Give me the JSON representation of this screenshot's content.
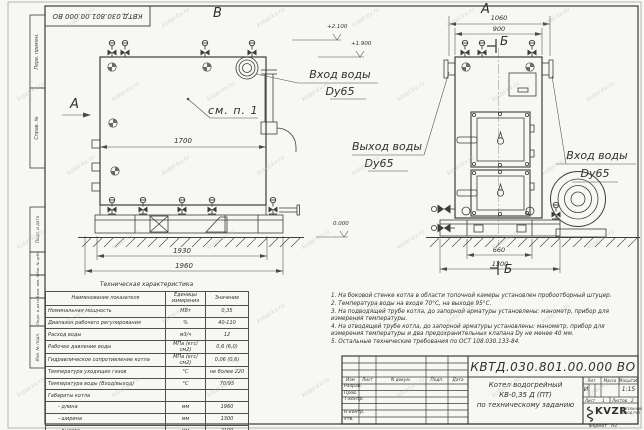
{
  "watermark": {
    "text": "kotel-kv.ru"
  },
  "margin": {
    "stamp": "КВТД.030.801.00.000 ВО",
    "cells": [
      "Перв. примен.",
      "Справ. №",
      "Подп. и дата",
      "Инв. № дубл.",
      "Взам. инв. №",
      "Подп. и дата",
      "Инв. № подл."
    ]
  },
  "views": {
    "front": {
      "label": "В",
      "arrow_label": "А",
      "see_note": "см. п. 1",
      "dims": {
        "width": "1700",
        "base": "1930",
        "overall": "1960"
      },
      "elevations": {
        "top": "+2.100",
        "pipe": "+1.900",
        "ground": "0.000"
      }
    },
    "side": {
      "label": "А",
      "section": "Б",
      "dims": {
        "overall_top": "1060",
        "body": "900",
        "base_inner": "660",
        "base": "1300"
      }
    },
    "callouts": {
      "inlet_front": {
        "line1": "Вход воды",
        "line2": "Dy65"
      },
      "outlet": {
        "line1": "Выход воды",
        "line2": "Dy65"
      },
      "inlet_side": {
        "line1": "Вход воды",
        "line2": "Dy65"
      }
    }
  },
  "tech_table": {
    "title": "Техническая характеристика",
    "headers": {
      "name": "Наименование показателя",
      "unit": "Единицы измерения",
      "value": "Значение"
    },
    "rows": [
      {
        "name": "Номинальная мощность",
        "unit": "МВт",
        "value": "0,35"
      },
      {
        "name": "Диапазон рабочего регулирования",
        "unit": "%",
        "value": "40-110"
      },
      {
        "name": "Расход воды",
        "unit": "м3/ч",
        "value": "12"
      },
      {
        "name": "Рабочее давление воды",
        "unit": "МПа (кгс/см2)",
        "value": "0,6 (6,0)"
      },
      {
        "name": "Гидравлическое сопротивление котла",
        "unit": "МПа (кгс/см2)",
        "value": "0,06 (0,6)"
      },
      {
        "name": "Температура уходящих газов",
        "unit": "°С",
        "value": "не более 220"
      },
      {
        "name": "Температура воды (Вход/выход)",
        "unit": "°С",
        "value": "70/95"
      },
      {
        "name": "Габариты котла",
        "unit": "",
        "value": ""
      },
      {
        "name": "- длина",
        "unit": "мм",
        "value": "1960"
      },
      {
        "name": "- ширина",
        "unit": "мм",
        "value": "1300"
      },
      {
        "name": "- высота",
        "unit": "мм",
        "value": "2100"
      }
    ]
  },
  "notes": {
    "lines": [
      "1. На боковой стенке котла в области топочной камеры установлен пробоотборный штуцер.",
      "2. Температура воды на входе 70°С, на выходе 95°С.",
      "3. На подводящей трубе котла, до запорной арматуры установлены: манометр, прибор для",
      "измерения температуры.",
      "4. На отводящей трубе котла, до запорной арматуры установлены: манометр, прибор для",
      "измерения температуры и два предохранительных клапана Dу не менее 40 мм.",
      "5. Остальные технические требования по ОСТ 108.030.133-84."
    ]
  },
  "title_block": {
    "doc_number": "КВТД.030.801.00.000 ВО",
    "product": {
      "line1": "Котел водогрейный",
      "line2": "КВ-0,35 Д (ПТ)",
      "line3": "по техническому заданию"
    },
    "cols": {
      "izm": "Изм",
      "list": "Лист",
      "docnum": "N докум.",
      "podp": "Подп.",
      "data": "Дата"
    },
    "rows": {
      "razrab": "Разраб.",
      "prov": "Пров.",
      "tkontr": "Т.контр.",
      "nkontr": "Н.контр.",
      "utv": "Утв."
    },
    "lit": {
      "header": "Лит.",
      "value": "И"
    },
    "mass": {
      "header": "Масса",
      "value": ""
    },
    "scale": {
      "header": "Масштаб",
      "value": "1:15"
    },
    "sheet": {
      "label": "Лист",
      "value": "1"
    },
    "sheets": {
      "label": "Листов",
      "value": "2"
    },
    "logo": {
      "name": "KVZR",
      "sub1": "КОТЕЛЬНЫЙ",
      "sub2": "ЗАВОД РЭП"
    },
    "format": {
      "label": "Формат",
      "value": "А3"
    }
  }
}
